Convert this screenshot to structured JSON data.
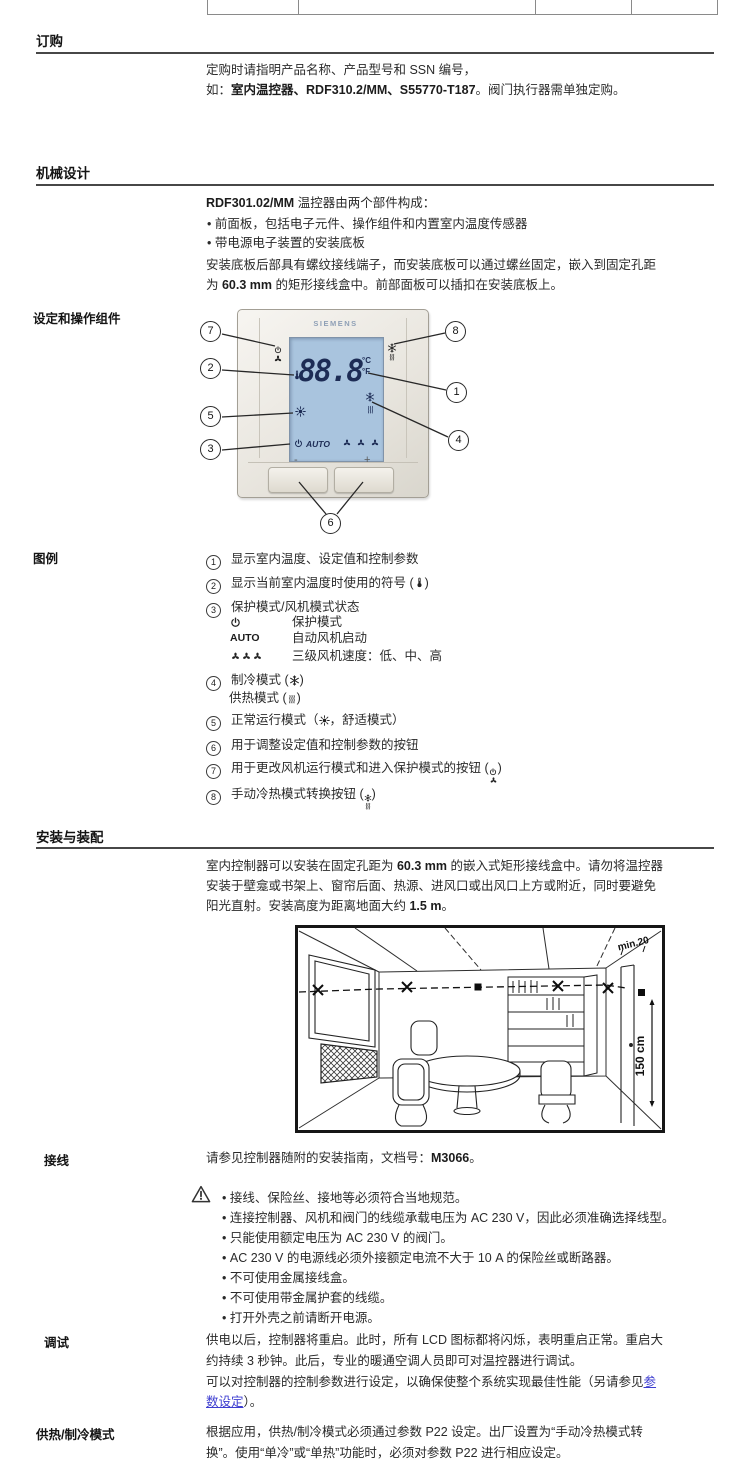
{
  "colors": {
    "lcd_blue": "#a9c4de",
    "lcd_digit_navy": "#1d2c55",
    "brand_gray_blue": "#8fa0b6",
    "link_blue": "#3d3dd0",
    "text": "#2a2a2a"
  },
  "ui": {
    "bullet": "•"
  },
  "ordering": {
    "heading": "订购",
    "line1": "定购时请指明产品名称、产品型号和 SSN 编号，",
    "line2_pre": "如：",
    "line2_bold": "室内温控器、RDF310.2/MM、S55770-T187",
    "line2_post": "。阀门执行器需单独定购。"
  },
  "mechanical": {
    "heading": "机械设计",
    "intro_model": "RDF301.02/MM",
    "intro_rest": " 温控器由两个部件构成：",
    "bullet1": "前面板，包括电子元件、操作组件和内置室内温度传感器",
    "bullet2": "带电源电子装置的安装底板",
    "para_line1": "安装底板后部具有螺纹接线端子，而安装底板可以通过螺丝固定，嵌入到固定孔距",
    "para_line2_pre": "为 ",
    "para_line2_bold": "60.3 mm",
    "para_line2_post": " 的矩形接线盒中。前部面板可以插扣在安装底板上。"
  },
  "controls": {
    "section_label": "设定和操作组件",
    "brand": "SIEMENS",
    "lcd_value": "88.8",
    "unit_top": "°C",
    "unit_bottom": "°F",
    "auto_label": "AUTO",
    "minus_label": "-",
    "plus_label": "+",
    "callouts": [
      "1",
      "2",
      "3",
      "4",
      "5",
      "6",
      "7",
      "8"
    ]
  },
  "legend": {
    "label": "图例",
    "items": [
      {
        "num": "1",
        "text": "显示室内温度、设定值和控制参数"
      },
      {
        "num": "2",
        "text_pre": "显示当前室内温度时使用的符号 (",
        "text_post": ")"
      },
      {
        "num": "3",
        "text": "保护模式/风机模式状态",
        "sub": [
          {
            "text": "保护模式"
          },
          {
            "label": "AUTO",
            "text": "自动风机启动"
          },
          {
            "text": "三级风机速度：低、中、高"
          }
        ]
      },
      {
        "num": "4",
        "line1_pre": "制冷模式 (",
        "line1_post": ")",
        "line2_pre": "供热模式 (",
        "line2_post": ")"
      },
      {
        "num": "5",
        "text_pre": "正常运行模式（",
        "text_post": "，舒适模式）"
      },
      {
        "num": "6",
        "text": "用于调整设定值和控制参数的按钮"
      },
      {
        "num": "7",
        "text_pre": "用于更改风机运行模式和进入保护模式的按钮 (",
        "text_post": ")"
      },
      {
        "num": "8",
        "text_pre": "手动冷热模式转换按钮 (",
        "text_post": ")"
      }
    ]
  },
  "mounting": {
    "heading": "安装与装配",
    "line1_pre": "室内控制器可以安装在固定孔距为 ",
    "line1_bold": "60.3 mm",
    "line1_post": " 的嵌入式矩形接线盒中。请勿将温控器",
    "line2": "安装于壁龛或书架上、窗帘后面、热源、进风口或出风口上方或附近，同时要避免",
    "line3_pre": "阳光直射。安装高度为距离地面大约 ",
    "line3_bold": "1.5 m",
    "line3_post": "。",
    "figure_min20": "min.20",
    "figure_height": "150 cm"
  },
  "wiring": {
    "label": "接线",
    "intro_pre": "请参见控制器随附的安装指南，文档号：",
    "intro_doc": "M3066",
    "intro_post": "。",
    "warnings": [
      "接线、保险丝、接地等必须符合当地规范。",
      "连接控制器、风机和阀门的线缆承载电压为 AC 230 V，因此必须准确选择线型。",
      "只能使用额定电压为 AC 230 V 的阀门。",
      "AC 230 V 的电源线必须外接额定电流不大于 10 A 的保险丝或断路器。",
      "不可使用金属接线盒。",
      "不可使用带金属护套的线缆。",
      "打开外壳之前请断开电源。"
    ]
  },
  "commissioning": {
    "label": "调试",
    "line1": "供电以后，控制器将重启。此时，所有 LCD 图标都将闪烁，表明重启正常。重启大",
    "line2": "约持续 3 秒钟。此后，专业的暖通空调人员即可对温控器进行调试。",
    "line3_pre": "可以对控制器的控制参数进行设定，以确保使整个系统实现最佳性能（另请参见",
    "line3_link": "参",
    "line4_link": "数设定",
    "line4_post": "）。"
  },
  "heat_cool": {
    "label": "供热/制冷模式",
    "line1": "根据应用，供热/制冷模式必须通过参数 P22 设定。出厂设置为“手动冷热模式转",
    "line2": "换”。使用“单冷”或“单热”功能时，必须对参数 P22 进行相应设定。"
  },
  "icons": {
    "thermometer": "thermometer-icon",
    "power": "power-icon",
    "fan": "fan-icon",
    "snowflake": "snowflake-icon",
    "heat": "heat-icon",
    "sun": "sun-icon",
    "warning": "warning-icon"
  }
}
